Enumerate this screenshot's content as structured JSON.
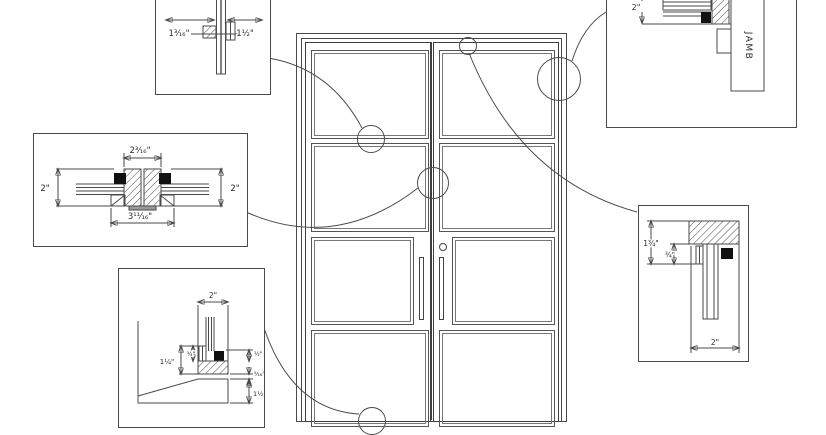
{
  "details": {
    "mullion": {
      "dim_left": "1³⁄₁₆\"",
      "dim_right": "1½\""
    },
    "meeting_stiles": {
      "dim_top": "2³⁄₁₆\"",
      "dim_left": "2\"",
      "dim_right": "2\"",
      "dim_bottom": "3¹¹⁄₁₆\""
    },
    "sill": {
      "dim_top": "2\"",
      "dim_left": "1¼\"",
      "dim_mid": "¾\"",
      "dim_right_top": "½\"",
      "dim_right_mid": "⁵⁄₁₆\"",
      "dim_right_bottom": "1½\""
    },
    "jamb": {
      "dim_top": "2\"",
      "label": "JAMB"
    },
    "head": {
      "dim_left": "1¾\"",
      "dim_mid": "¾\"",
      "dim_bottom": "2\""
    }
  },
  "colors": {
    "line": "#4a4a4a",
    "solid_black": "#111111",
    "background": "#ffffff"
  }
}
